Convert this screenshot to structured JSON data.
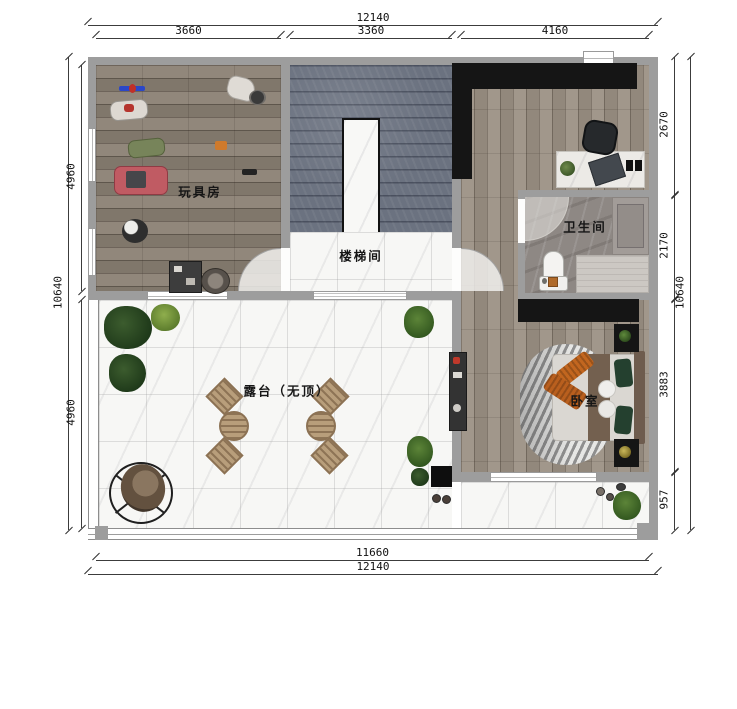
{
  "rooms": {
    "toy_room": "玩具房",
    "stairwell": "楼梯间",
    "bathroom": "卫生间",
    "bedroom": "卧室",
    "terrace": "露台（无顶）"
  },
  "dims": {
    "top_total": "12140",
    "top_segments": [
      "3660",
      "3360",
      "4160"
    ],
    "bottom_inner": "11660",
    "bottom_total": "12140",
    "left_total": "10640",
    "left_segments": [
      "4960",
      "4960"
    ],
    "right_total": "10640",
    "right_segments": [
      "2670",
      "2170",
      "3883",
      "957"
    ]
  },
  "colors": {
    "wall": "#9d9d9d",
    "black_furniture": "#151515",
    "wood_dark_floor": "#8b8174",
    "wood_light_floor": "#9b9184",
    "slate_stairs": "#6b7280",
    "marble": "#f7f7f5",
    "accent_orange": "#c2661f",
    "plant_green": "#2e4a26",
    "toy_car_pink": "#c05b63"
  }
}
